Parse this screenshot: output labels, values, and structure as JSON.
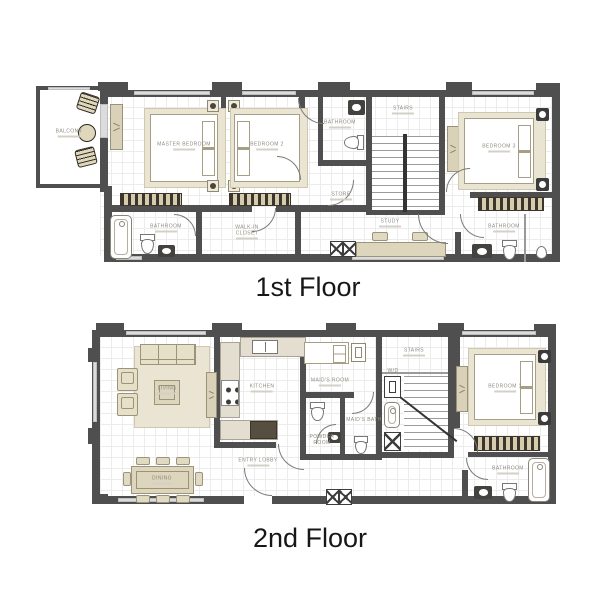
{
  "colors": {
    "wall": "#4f4f4f",
    "furniture_fill": "#ddd6bd",
    "furniture_edge": "#9b937a",
    "room_label_text": "#8f8b80",
    "title_text": "#171717",
    "floor_grid": "#ececec"
  },
  "floor1": {
    "title": "1st Floor",
    "labels": {
      "balcony": "BALCONY",
      "master_bedroom": "MASTER BEDROOM",
      "bedroom2": "BEDROOM 2",
      "bathroom_mid": "BATHROOM",
      "store": "STORE",
      "stairs": "STAIRS",
      "bedroom3": "BEDROOM 3",
      "bathroom_left": "BATHROOM",
      "walkin_closet": "WALK-IN CLOSET",
      "study": "STUDY",
      "bathroom_right": "BATHROOM"
    }
  },
  "floor2": {
    "title": "2nd Floor",
    "labels": {
      "living": "LIVING",
      "dining": "DINING",
      "kitchen": "KITCHEN",
      "entry_lobby": "ENTRY LOBBY",
      "maids_room": "MAID'S ROOM",
      "wd": "W/D",
      "stairs": "STAIRS",
      "maids_bath": "MAID'S BATH",
      "powder_room": "POWDER ROOM",
      "bedroom1": "BEDROOM 1",
      "bathroom": "BATHROOM"
    }
  }
}
